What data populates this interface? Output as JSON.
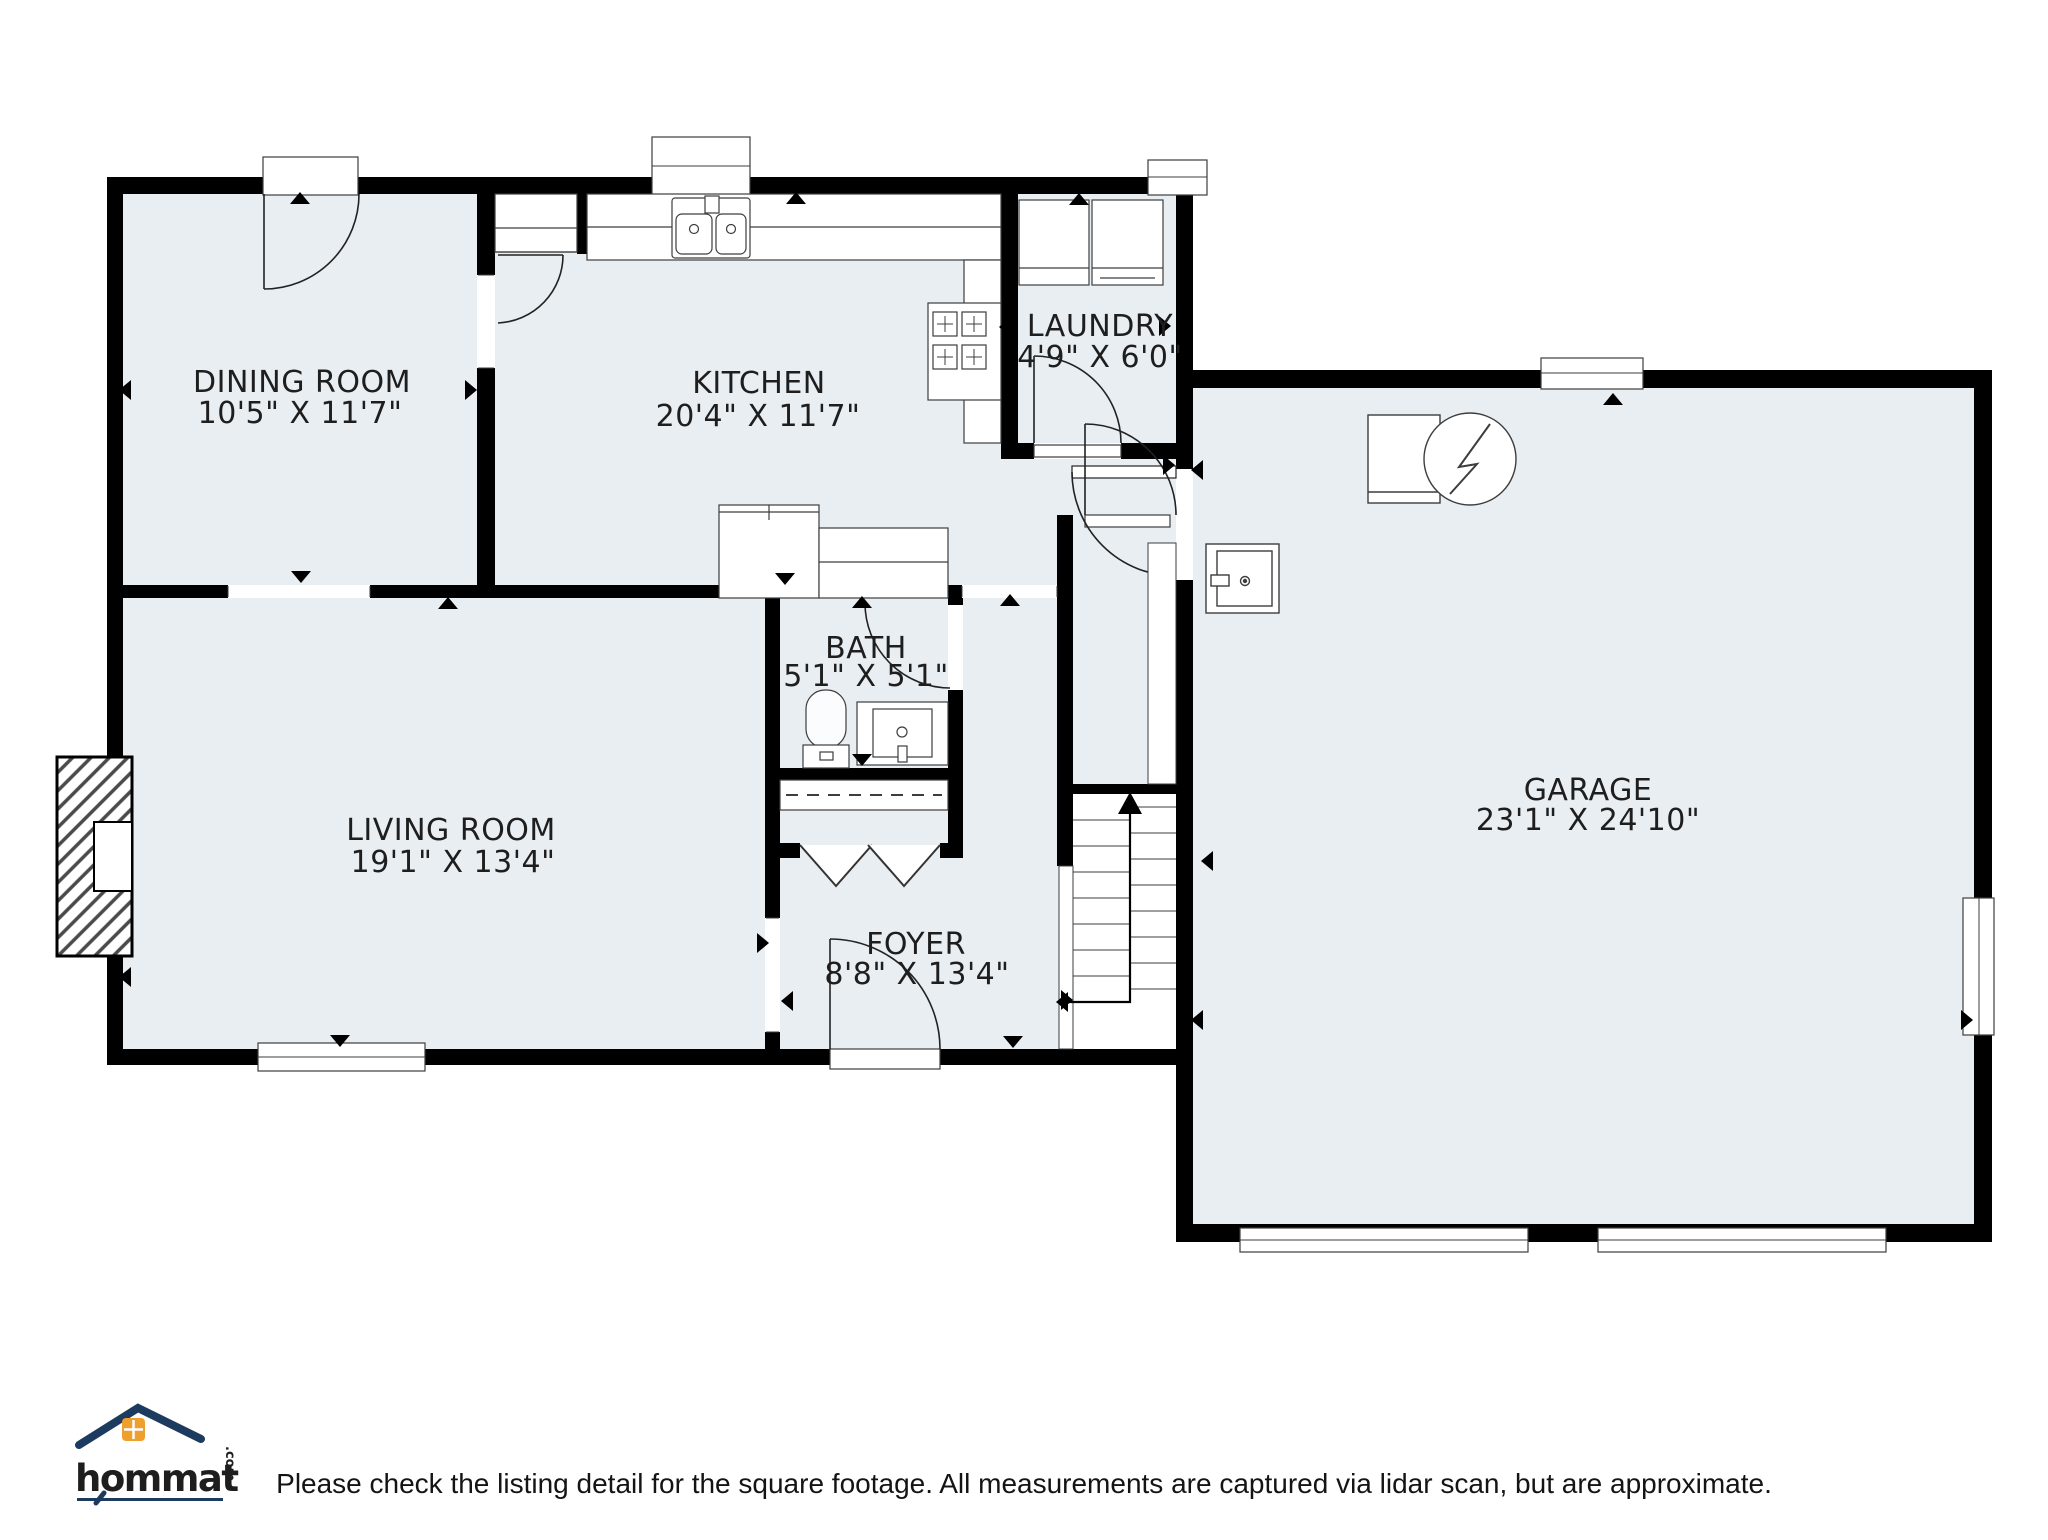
{
  "rooms": [
    {
      "id": "dining-room",
      "name": "DINING ROOM",
      "dims": "10'5\" X 11'7\""
    },
    {
      "id": "kitchen",
      "name": "KITCHEN",
      "dims": "20'4\" X 11'7\""
    },
    {
      "id": "laundry",
      "name": "LAUNDRY",
      "dims": "4'9\" X 6'0\""
    },
    {
      "id": "bath",
      "name": "BATH",
      "dims": "5'1\" X 5'1\""
    },
    {
      "id": "living-room",
      "name": "LIVING ROOM",
      "dims": "19'1\" X 13'4\""
    },
    {
      "id": "foyer",
      "name": "FOYER",
      "dims": "8'8\" X 13'4\""
    },
    {
      "id": "garage",
      "name": "GARAGE",
      "dims": "23'1\" X 24'10\""
    }
  ],
  "fixtures": [
    "kitchen-sink",
    "stove",
    "refrigerator",
    "kitchen-island",
    "pantry",
    "washer",
    "dryer",
    "toilet",
    "bathroom-vanity",
    "closet-rod",
    "bifold-doors",
    "fireplace",
    "staircase",
    "water-heater",
    "freezer",
    "electrical-panel"
  ],
  "logo": {
    "brand": "hommati",
    "tld": ".com"
  },
  "footer": {
    "disclaimer": "Please check the listing detail for the square footage. All measurements are captured via lidar scan, but are approximate."
  },
  "colors": {
    "floor": "#e9eef2",
    "wall": "#000000",
    "line": "#3d3d3d",
    "text": "#1e1e1e",
    "logo_navy": "#1d3a5f",
    "logo_orange": "#ee9f2e"
  }
}
